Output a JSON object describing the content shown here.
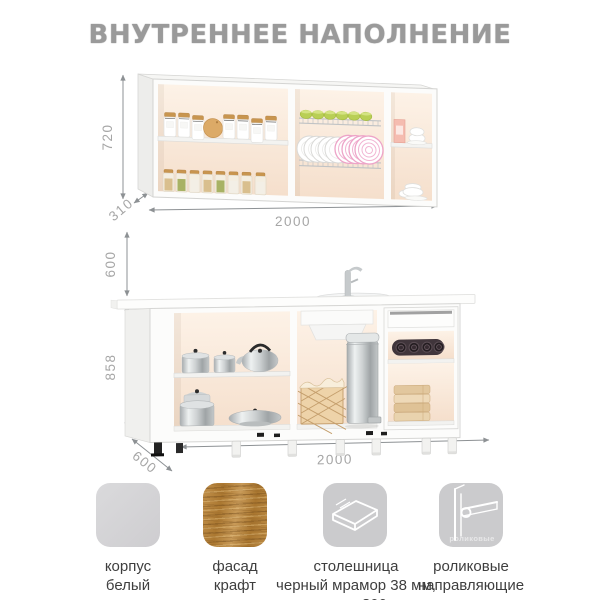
{
  "title": "ВНУТРЕННЕЕ НАПОЛНЕНИЕ",
  "wall_cabinet": {
    "height_mm": "720",
    "depth_mm": "310",
    "width_mm": "2000"
  },
  "gap_height_mm": "600",
  "base_cabinet": {
    "height_mm": "858",
    "depth_mm": "600",
    "width_mm": "2000"
  },
  "features": [
    {
      "id": "body-white",
      "label_line1": "корпус",
      "label_line2": "белый"
    },
    {
      "id": "facade-craft",
      "label_line1": "фасад",
      "label_line2": "крафт"
    },
    {
      "id": "countertop",
      "label_line1": "столешница",
      "label_line2": "черный мрамор 38 мм,",
      "label_line3": "цельная 800 мм"
    },
    {
      "id": "roller-guides",
      "label_line1": "роликовые",
      "label_line2": "направляющие",
      "icon_caption": "роликовые"
    }
  ],
  "colors": {
    "title_gray": "#9a9a9a",
    "dimension_text": "#a6a6a6",
    "dimension_line": "#8d9194",
    "label_text": "#3e3e3e",
    "swatch_gray": "#cfcfd1",
    "wood_base": "#b6883f",
    "interior_cream": "#f9e9da"
  }
}
